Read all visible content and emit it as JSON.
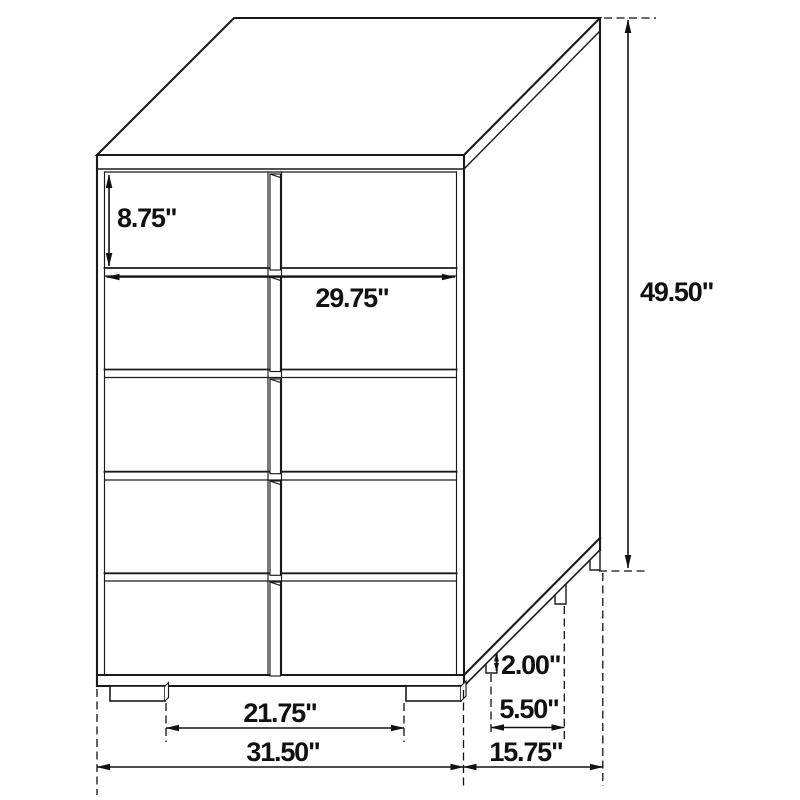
{
  "diagram": {
    "kind": "furniture-dimension-drawing",
    "labels": {
      "top_drawer_height": "8.75\"",
      "drawer_front_width": "29.75\"",
      "overall_height": "49.50\"",
      "leg_height": "2.00\"",
      "side_leg_spacing": "5.50\"",
      "front_leg_spacing": "21.75\"",
      "overall_width": "31.50\"",
      "overall_depth": "15.75\""
    },
    "colors": {
      "line": "#1a1a1a",
      "dimension_line": "#111111",
      "text": "#111111",
      "background": "#ffffff"
    }
  }
}
